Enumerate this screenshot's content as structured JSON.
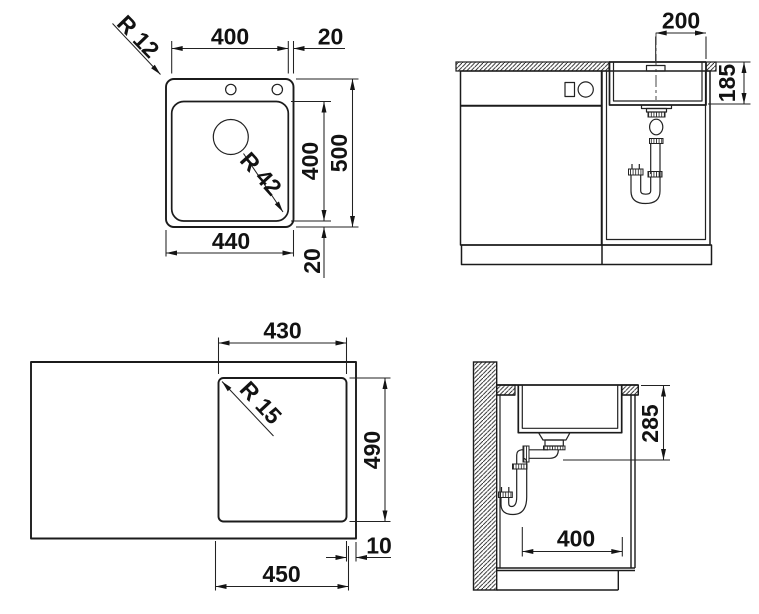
{
  "drawing": {
    "background": "#ffffff",
    "line_color": "#1b1b1b",
    "text_color": "#121212",
    "top_view": {
      "outer_radius": "R 12",
      "bowl_width": "400",
      "rim_right": "20",
      "bowl_length": "400",
      "overall_length": "500",
      "bowl_radius": "R 42",
      "overall_width": "440",
      "rim_bottom": "20"
    },
    "front_view": {
      "drain_offset": "200",
      "bowl_depth": "185"
    },
    "cutout_view": {
      "cutout_width": "430",
      "cutout_radius": "R 15",
      "cutout_length": "490",
      "edge_gap": "10",
      "rim_width": "450"
    },
    "side_view": {
      "outlet_height": "285",
      "bowl_depth_front_back": "400"
    }
  }
}
